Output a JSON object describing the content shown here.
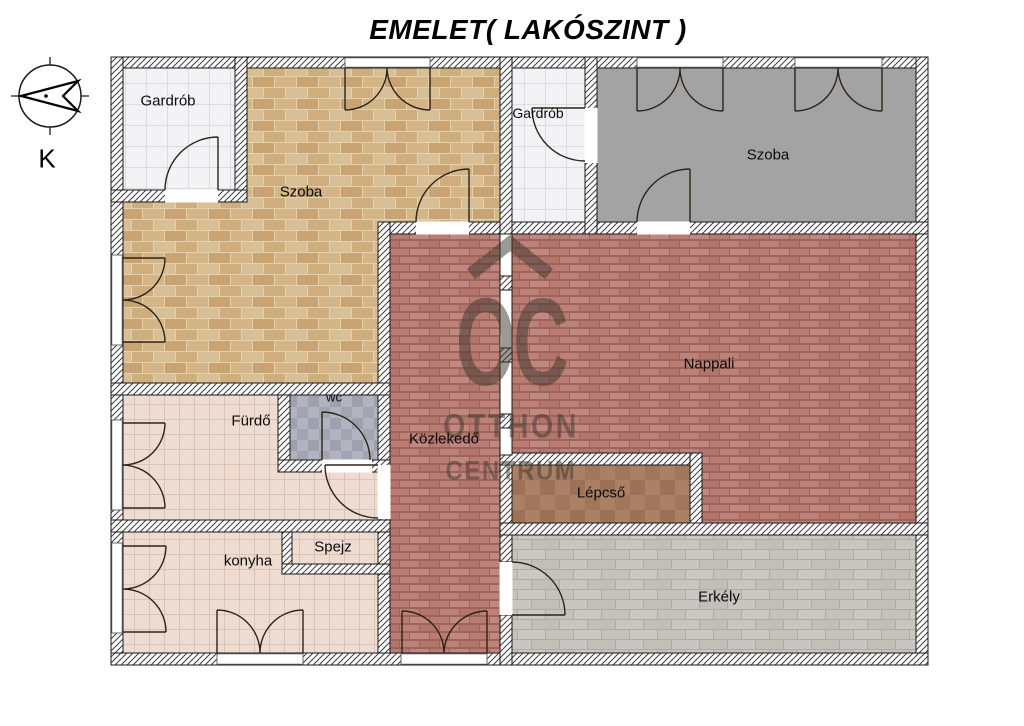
{
  "title": "EMELET( LAKÓSZINT )",
  "compass": {
    "label": "K"
  },
  "watermark": {
    "monogram": "OC",
    "line1": "OTTHON",
    "line2": "CENTRUM"
  },
  "rooms": {
    "gardrob1": {
      "label": "Gardrób"
    },
    "szoba1": {
      "label": "Szoba"
    },
    "gardrob2": {
      "label": "Gardrób"
    },
    "szoba2": {
      "label": "Szoba"
    },
    "nappali": {
      "label": "Nappali"
    },
    "kozlekedo": {
      "label": "Közlekedő"
    },
    "furdo": {
      "label": "Fürdő"
    },
    "wc": {
      "label": "wc"
    },
    "lepcso": {
      "label": "Lépcső"
    },
    "konyha": {
      "label": "konyha"
    },
    "spejz": {
      "label": "Spejz"
    },
    "erkely": {
      "label": "Erkély"
    }
  },
  "colors": {
    "szoba1_floor": "#d2b488",
    "szoba2_floor": "#a3a3a3",
    "nappali_floor": "#b97e74",
    "bath_kitchen_floor": "#eedcd2",
    "wardrobe_floor": "#f3f3f6",
    "wc_floor": "#a7a9b4",
    "stairs_floor": "#a37a5e",
    "balcony_floor": "#c6c3bd",
    "watermark": "#423a32",
    "line": "#1a1a1a"
  }
}
